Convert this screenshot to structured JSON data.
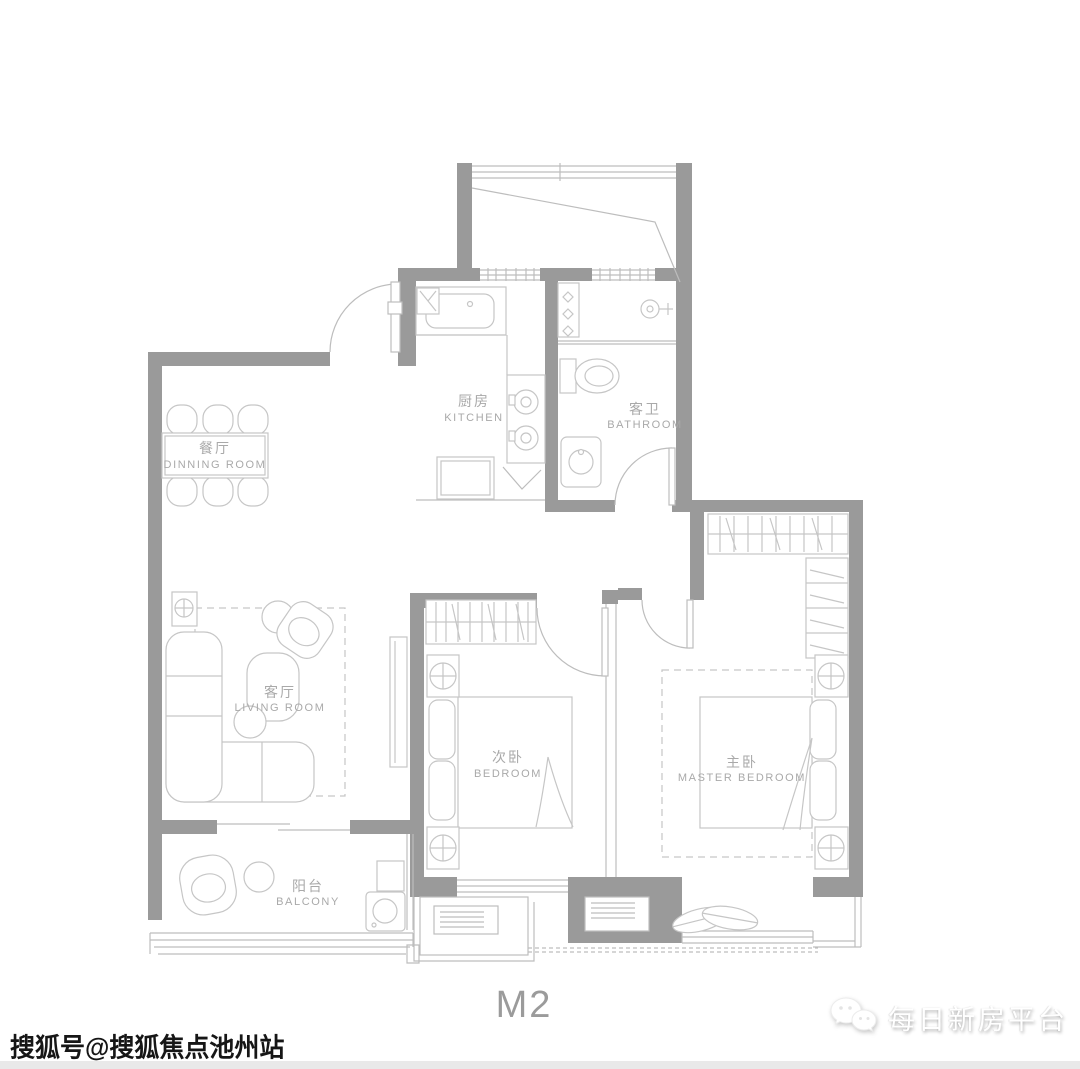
{
  "plan": {
    "code": "M2",
    "type_label": "floor-plan"
  },
  "rooms": {
    "dining": {
      "cn": "餐厅",
      "en": "DINNING ROOM"
    },
    "kitchen": {
      "cn": "厨房",
      "en": "KITCHEN"
    },
    "bathroom": {
      "cn": "客卫",
      "en": "BATHROOM"
    },
    "living": {
      "cn": "客厅",
      "en": "LIVING ROOM"
    },
    "bedroom2": {
      "cn": "次卧",
      "en": "BEDROOM"
    },
    "master": {
      "cn": "主卧",
      "en": "MASTER BEDROOM"
    },
    "balcony": {
      "cn": "阳台",
      "en": "BALCONY"
    }
  },
  "watermarks": {
    "sohu": "搜狐号@搜狐焦点池州站",
    "platform": "每日新房平台"
  },
  "colors": {
    "wall": "#9a9a9a",
    "furniture_line": "#c6c6c6",
    "window_line": "#bdbdbd",
    "label_text": "#a9a9a9",
    "plan_code_text": "#9b9b9b",
    "background": "#ffffff"
  }
}
